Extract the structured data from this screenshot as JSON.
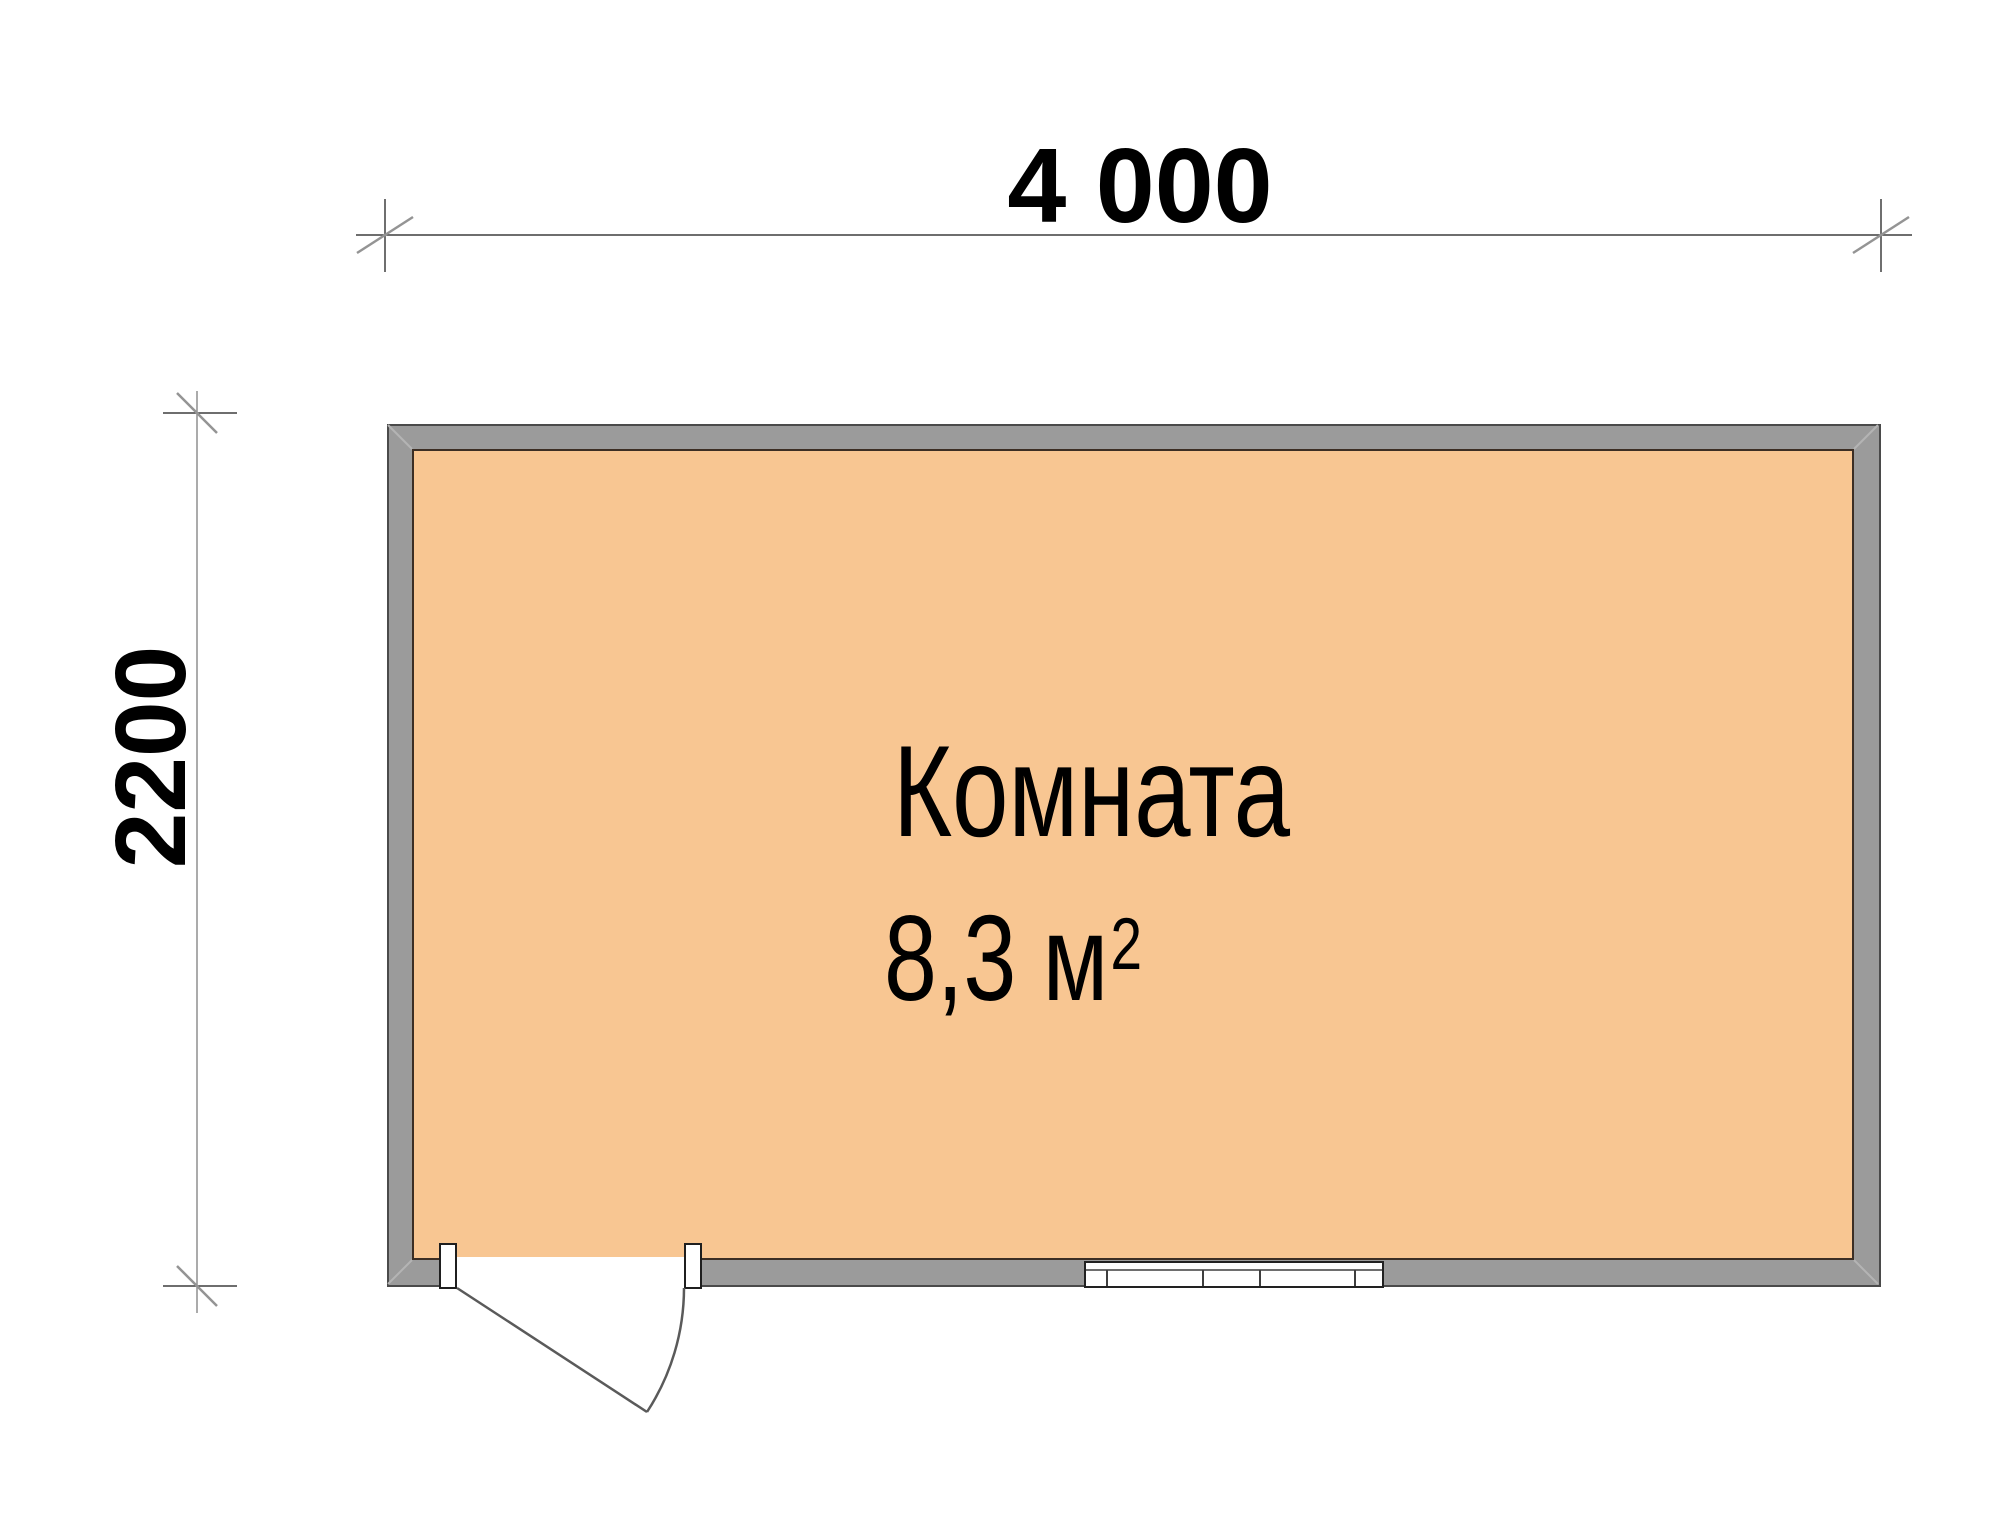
{
  "drawing": {
    "room_label": "Комната",
    "area_value": "8,3 м",
    "area_sup": "2",
    "dim_width": "4 000",
    "dim_height": "2200"
  },
  "colors": {
    "background": "#ffffff",
    "floor_fill": "#f8c692",
    "wall_fill": "#9b9b9b",
    "wall_outline": "#4a4a4a",
    "floor_outline": "#3c2e24",
    "miter_line": "#b4b4b4",
    "door_line": "#5a5a5a",
    "window_frame": "#222222",
    "window_mullion": "#3f3f3f",
    "dim_line": "#3f3f3f",
    "dim_line_light": "#8f8f8f",
    "tick_slash": "#949494",
    "text": "#000000"
  }
}
